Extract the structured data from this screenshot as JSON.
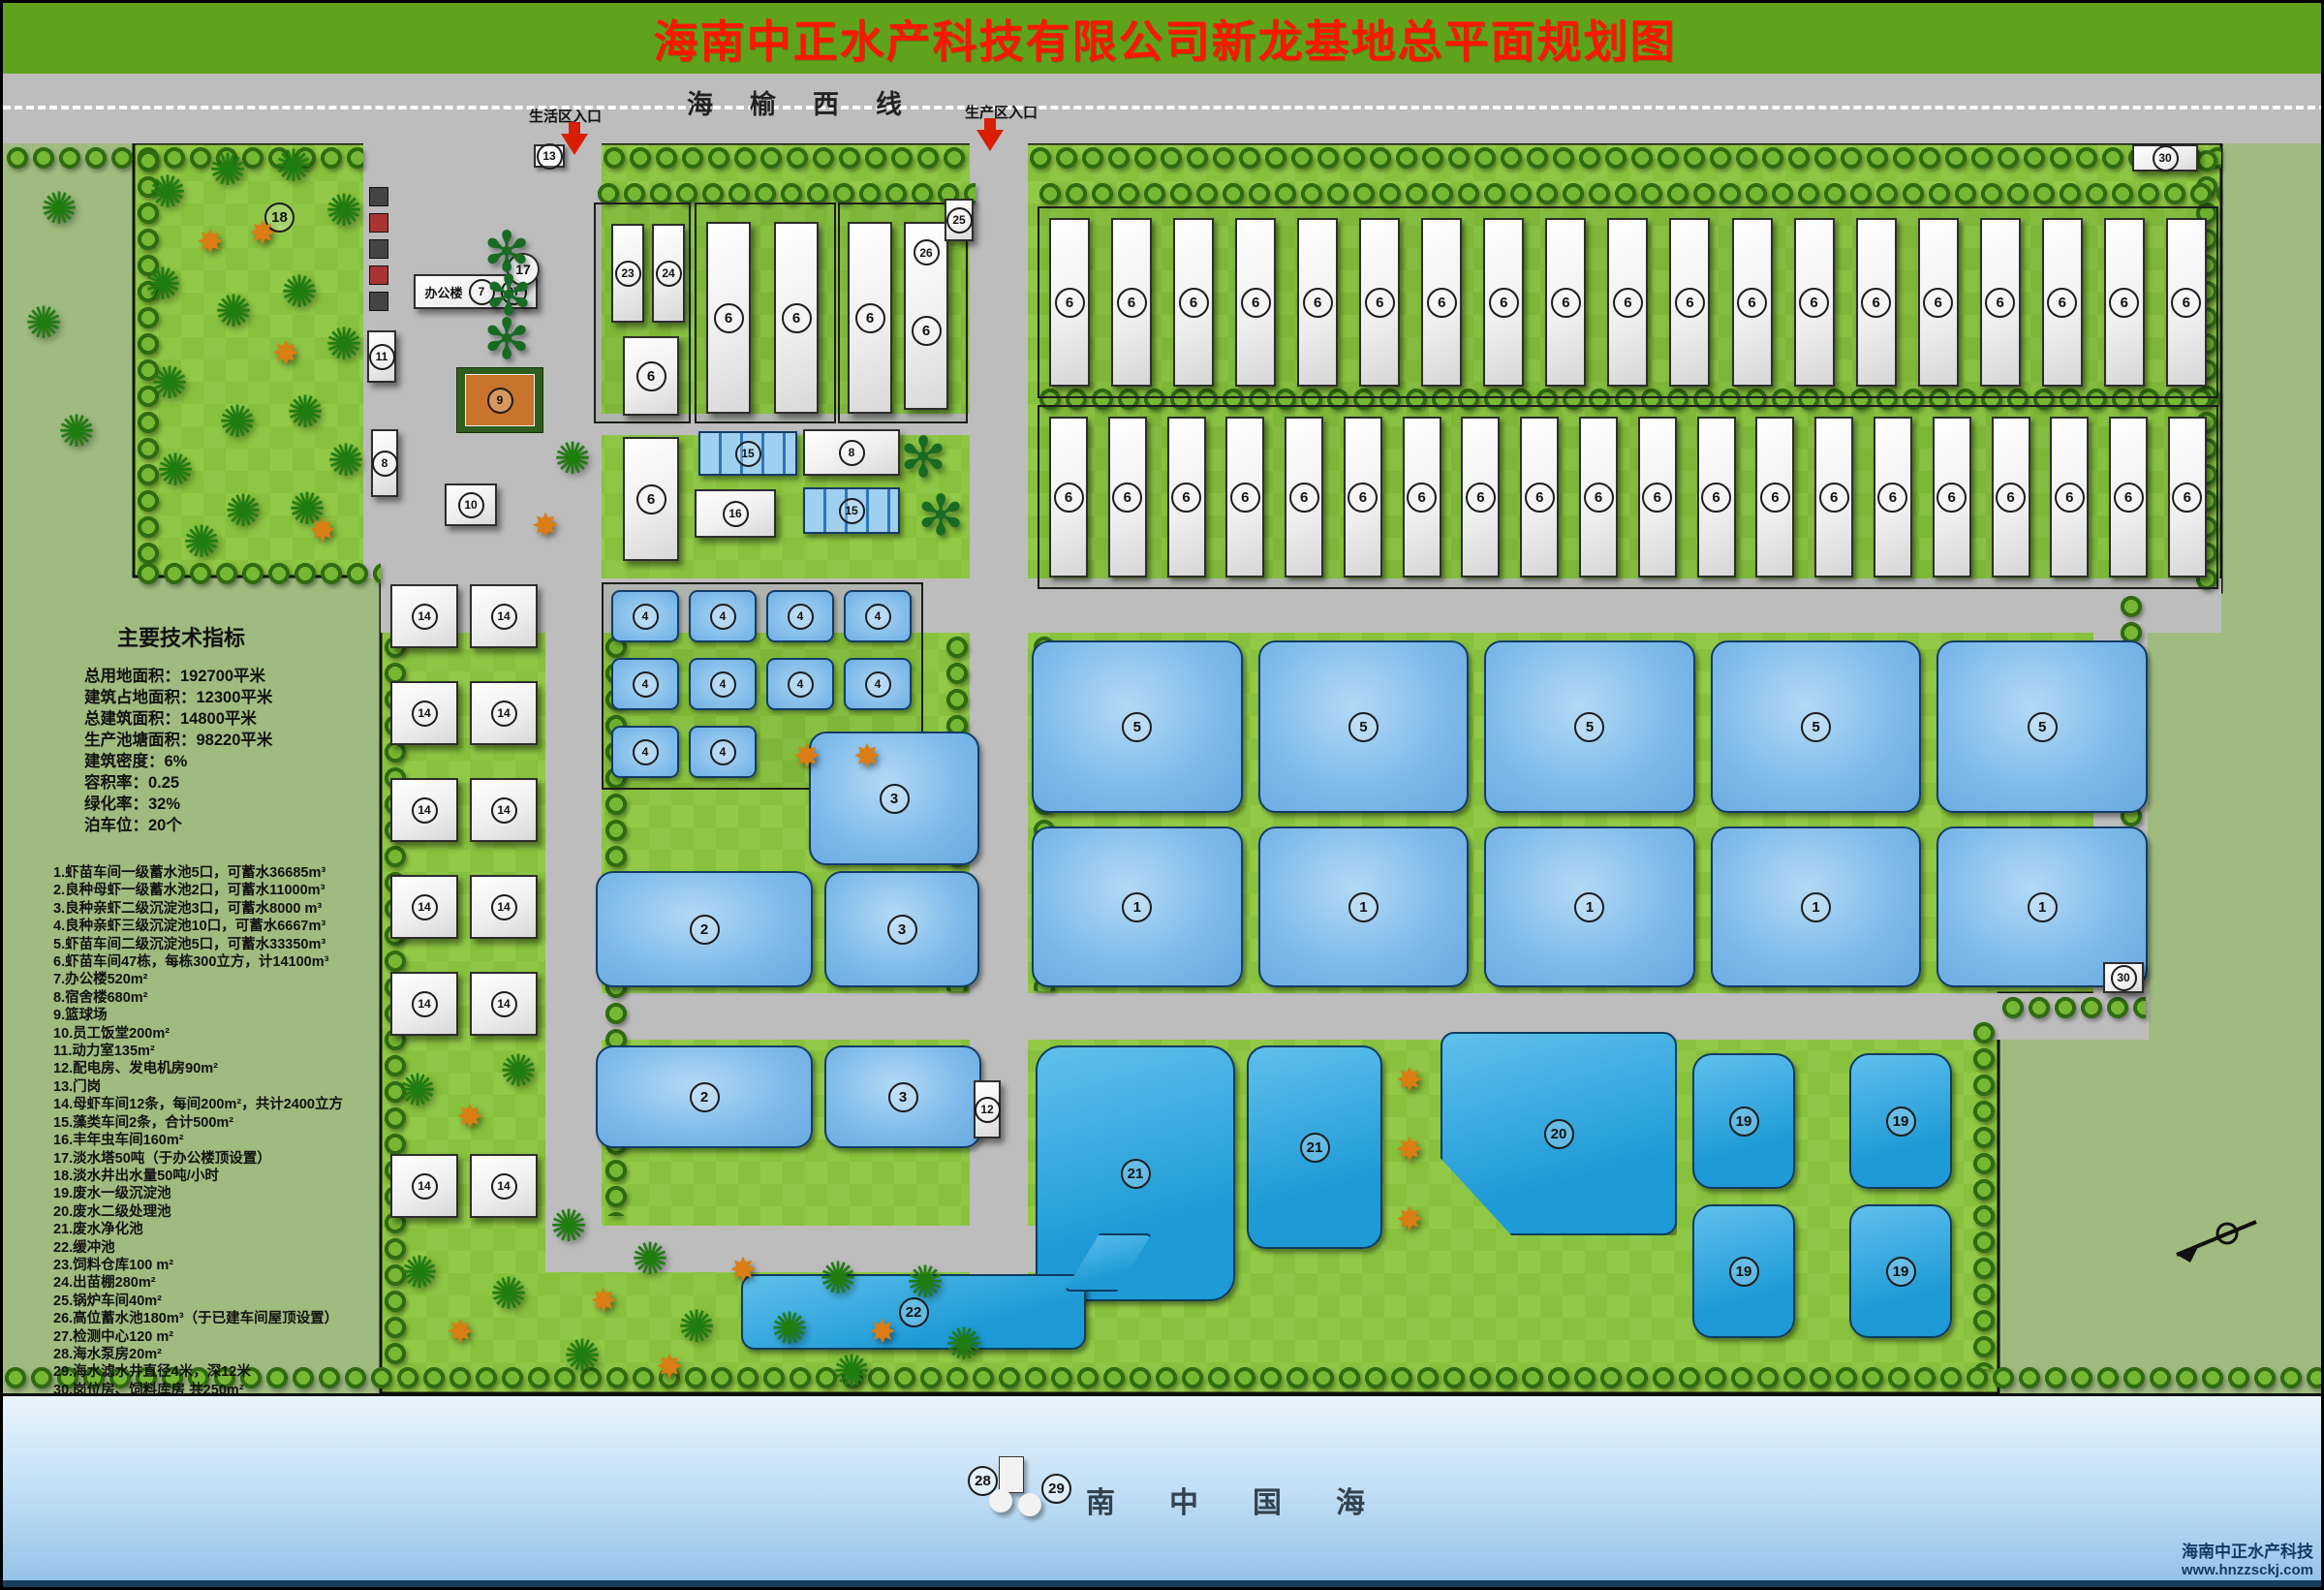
{
  "title": "海南中正水产科技有限公司新龙基地总平面规划图",
  "road": {
    "name_chars": [
      "海",
      "榆",
      "西",
      "线"
    ],
    "life_entrance": "生活区入口",
    "prod_entrance": "生产区入口"
  },
  "tech": {
    "title": "主要技术指标",
    "lines": [
      "总用地面积：192700平米",
      "建筑占地面积：12300平米",
      "总建筑面积：14800平米",
      "生产池塘面积：98220平米",
      "建筑密度：6%",
      "容积率：0.25",
      "绿化率：32%",
      "泊车位：20个"
    ]
  },
  "legend": [
    "1.虾苗车间一级蓄水池5口，可蓄水36685m³",
    "2.良种母虾一级蓄水池2口，可蓄水11000m³",
    "3.良种亲虾二级沉淀池3口，可蓄水8000 m³",
    "4.良种亲虾三级沉淀池10口，可蓄水6667m³",
    "5.虾苗车间二级沉淀池5口，可蓄水33350m³",
    "6.虾苗车间47栋，每栋300立方，计14100m³",
    "7.办公楼520m²",
    "8.宿舍楼680m²",
    "9.篮球场",
    "10.员工饭堂200m²",
    "11.动力室135m²",
    "12.配电房、发电机房90m²",
    "13.门岗",
    "14.母虾车间12条，每间200m²，共计2400立方",
    "15.藻类车间2条，合计500m²",
    "16.丰年虫车间160m²",
    "17.淡水塔50吨（于办公楼顶设置）",
    "18.淡水井出水量50吨/小时",
    "19.废水一级沉淀池",
    "20.废水二级处理池",
    "21.废水净化池",
    "22.缓冲池",
    "23.饲料仓库100 m²",
    "24.出苗棚280m²",
    "25.锅炉车间40m²",
    "26.高位蓄水池180m³（于已建车间屋顶设置）",
    "27.检测中心120 m²",
    "28.海水泵房20m²",
    "29.海水滤水井直径4米，深12米",
    "30.岗位房、饲料库房 共250m²"
  ],
  "sea": {
    "name_chars": [
      "南",
      "中",
      "国",
      "海"
    ]
  },
  "credit": {
    "company": "海南中正水产科技",
    "website": "www.hnzzsckj.com"
  },
  "marks": {
    "forest": "18",
    "gate": "13",
    "power": "11",
    "dorm_a": "8",
    "court": "9",
    "office_name": "办公楼",
    "office": "7",
    "test_center": "27",
    "water_tower": "17",
    "canteen": "10",
    "feed_store": "23",
    "nursery_shed": "24",
    "boiler": "25",
    "high_tank": "26",
    "algae_a": "15",
    "algae_b": "15",
    "dorm_b": "8",
    "brine_shrimp": "16",
    "pond2_a": "2",
    "pond3_a": "3",
    "pond3_b": "3",
    "pond2_b": "2",
    "pond3_c": "3",
    "power_dist": "12",
    "purify_a": "21",
    "purify_b": "21",
    "secondary_treat": "20",
    "buffer": "22",
    "guard_a": "30",
    "guard_b": "30",
    "sea_pump": "28",
    "sea_well": "29"
  },
  "zones": {
    "workshops_top": {
      "label": "6",
      "count": 19
    },
    "workshops_bottom": {
      "label": "6",
      "count": 20
    },
    "ponds_row5": {
      "label": "5",
      "count": 5
    },
    "ponds_row1": {
      "label": "1",
      "count": 5
    },
    "tanks4": {
      "label": "4",
      "rows": [
        4,
        4,
        2
      ]
    },
    "mother14": {
      "label": "14",
      "count": 12
    },
    "waste19": {
      "label": "19",
      "count": 4
    }
  },
  "icons": {
    "tree": "✺",
    "orange_tree": "✸",
    "palm": "✻"
  },
  "colors": {
    "banner_green": "#5fa31d",
    "title_red": "#ff1605",
    "road_grey": "#bdbdbd",
    "site_green": "#8ac33f",
    "outside_green": "#9fbb7f",
    "pond_blue": "#7cb9ea",
    "waste_blue": "#1e9ad6",
    "sea_top": "#e9f4fc",
    "sea_bottom": "#8fc0e6",
    "building_white": "#f4f4f4"
  }
}
